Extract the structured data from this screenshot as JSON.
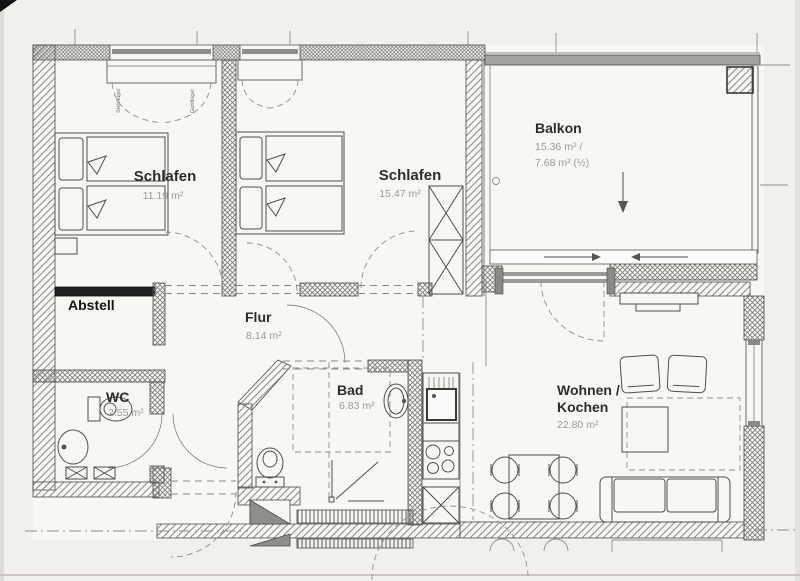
{
  "drawing": {
    "type": "apartment-floor-plan",
    "rooms": {
      "schlafen1": {
        "label": "Schlafen",
        "area": "11.19 m²"
      },
      "schlafen2": {
        "label": "Schlafen",
        "area": "15.47 m²"
      },
      "balkon": {
        "label": "Balkon",
        "area1": "15.36 m² /",
        "area2": "7.68 m² (½)"
      },
      "abstell": {
        "label": "Abstell"
      },
      "flur": {
        "label": "Flur",
        "area": "8.14 m²"
      },
      "wc": {
        "label": "WC",
        "area": "2.55 m²"
      },
      "bad": {
        "label": "Bad",
        "area": "6.83 m²"
      },
      "wohnen_kochen": {
        "label1": "Wohnen /",
        "label2": "Kochen",
        "area": "22.80 m²"
      }
    },
    "annotations": {
      "window_sash_left": "Stehflügel",
      "window_sash_right": "Gehflügel",
      "balcony_down_arrow": "↓",
      "sill_arrow_right": "→",
      "sill_arrow_left": "←"
    },
    "colors": {
      "paper": "#f1f0ec",
      "floor": "#f8f7f4",
      "line": "#4f4f4d",
      "label_text": "#2d2d2b",
      "area_text": "#9a9a96",
      "dark_bar": "#222222",
      "mid_gray": "#8e8e8a"
    }
  }
}
